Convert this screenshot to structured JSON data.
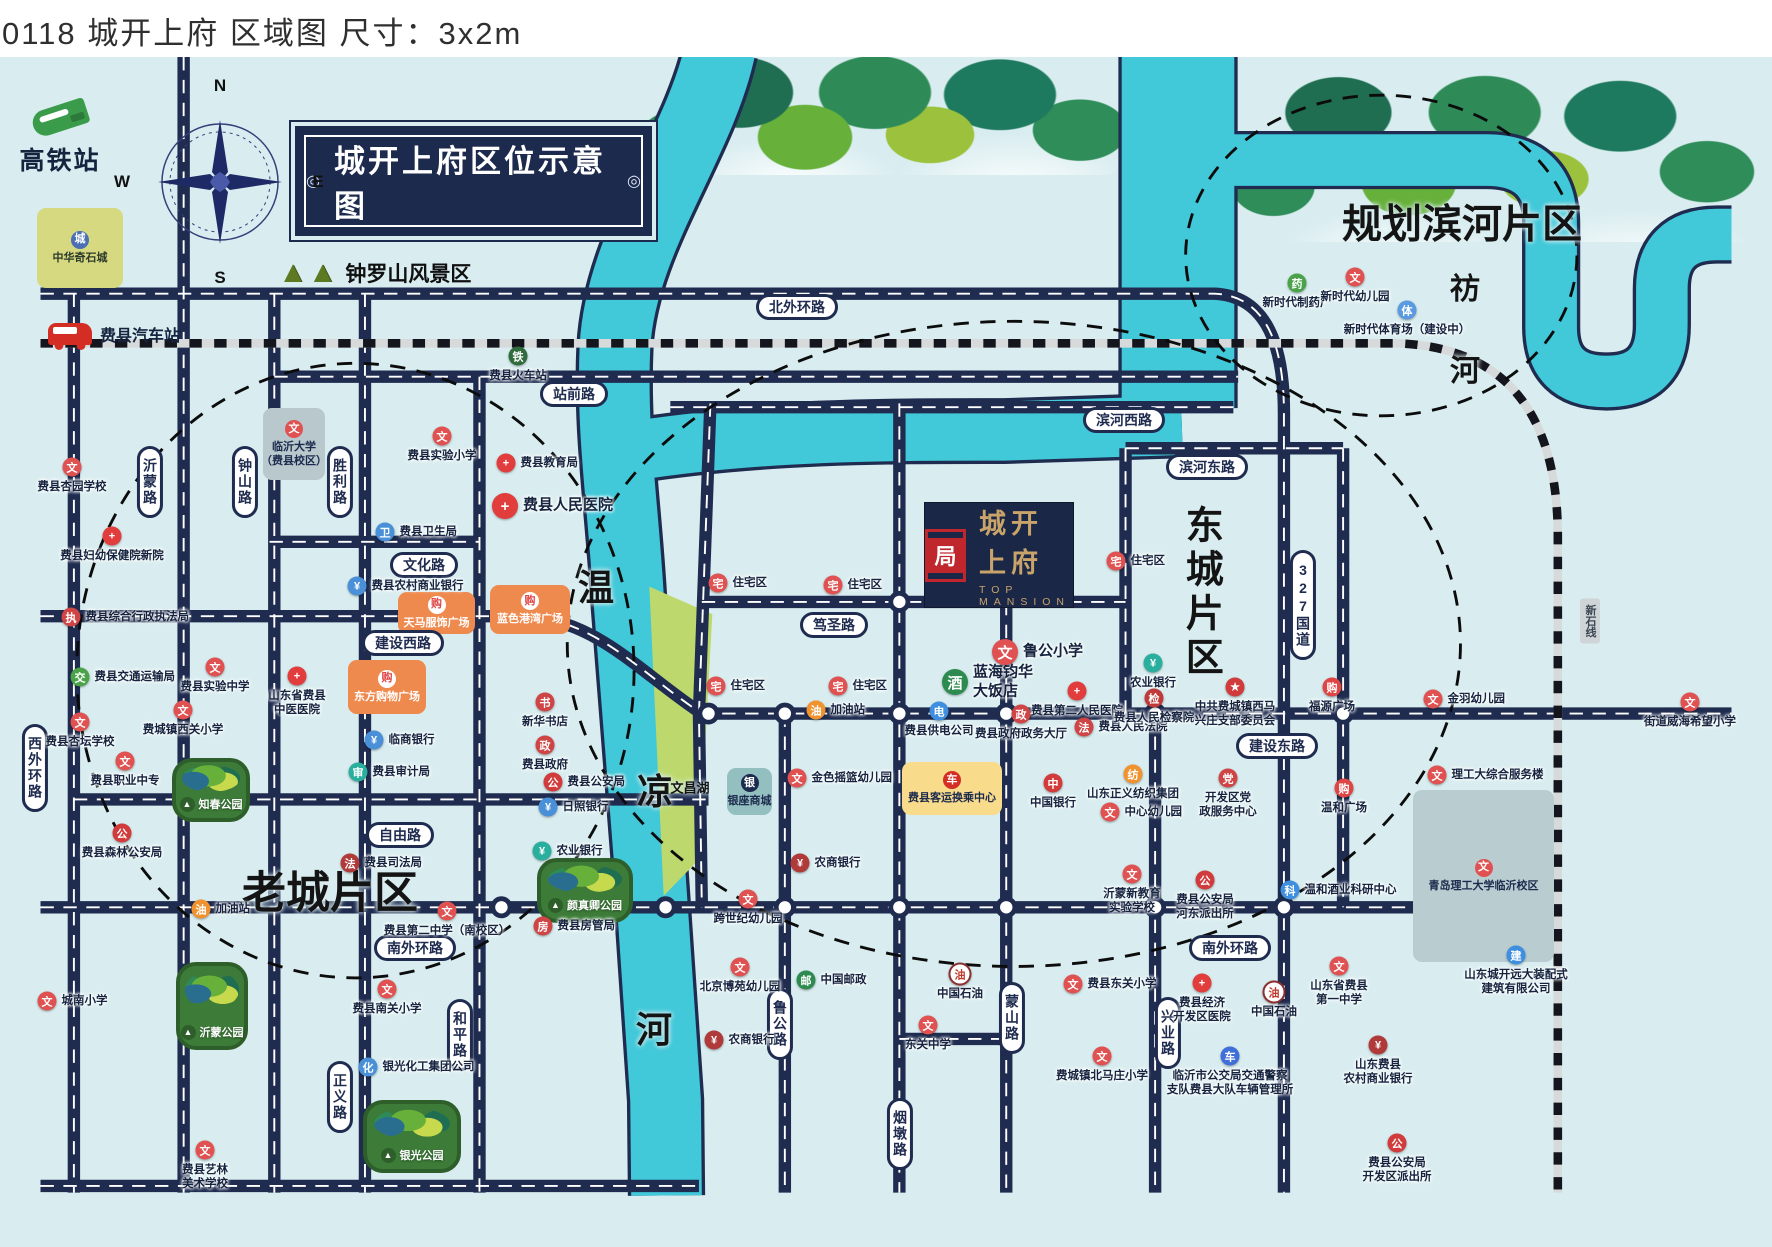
{
  "header": {
    "title": "0118 城开上府 区域图 尺寸：3x2m"
  },
  "banner": {
    "text": "城开上府区位示意图",
    "deco": "◎",
    "x": 295,
    "y": 126,
    "w": 353,
    "h": 106
  },
  "compass": {
    "n": "N",
    "e": "E",
    "s": "S",
    "w": "W",
    "cx": 220,
    "cy": 182,
    "r": 56
  },
  "hsr_station": {
    "label": "高铁站",
    "x": 14,
    "y": 105,
    "w": 92
  },
  "bus_station": {
    "label": "费县汽车站",
    "x": 48,
    "y": 322
  },
  "scenic": {
    "label": "钟罗山风景区",
    "trees": "▲▲",
    "x": 278,
    "y": 258
  },
  "logo": {
    "cn": "城开上府",
    "en": "TOP MANSION",
    "seal": "局",
    "x": 925,
    "y": 503,
    "w": 148,
    "h": 104
  },
  "colors": {
    "bg": "#d9edf0",
    "road": "#1f2c50",
    "river": "#41c8d9",
    "lake": "#bdd96d",
    "rail_base": "#d7dadb",
    "rail_dash": "#15151d",
    "navy": "#1c2a4d",
    "gold": "#c8a36a",
    "seal_red": "#c0272d",
    "orange_box": "#ef8a4e",
    "yellow_box": "#f8dc8c",
    "teal_box": "#93bfc0",
    "gray_box": "#b9cdd1",
    "park_green": "#3c7c38"
  },
  "icon_styles": {
    "school": {
      "bg": "#e05151",
      "g": "文"
    },
    "hospital": {
      "bg": "#e23d3d",
      "g": "+"
    },
    "bankblue": {
      "bg": "#4a90d9",
      "g": "¥"
    },
    "bankred": {
      "bg": "#b03a3a",
      "g": "¥"
    },
    "teal": {
      "bg": "#2aaf9e",
      "g": "¥"
    },
    "govblue": {
      "bg": "#4a90d9",
      "g": "卫"
    },
    "govred": {
      "bg": "#cf4444",
      "g": "政"
    },
    "court": {
      "bg": "#c13a3a",
      "g": "检"
    },
    "pin": {
      "bg": "#d23b3b",
      "g": "公"
    },
    "star": {
      "bg": "#d03b3b",
      "g": "★"
    },
    "green": {
      "bg": "#4aa348",
      "g": "交"
    },
    "gas": {
      "bg": "#f0932f",
      "g": "油"
    },
    "home": {
      "bg": "#e05151",
      "g": "宅"
    },
    "hotel": {
      "bg": "#2e8b4f",
      "g": "酒"
    },
    "power": {
      "bg": "#3f8fe0",
      "g": "电"
    },
    "boc": {
      "bg": "#d23b3b",
      "g": "中"
    },
    "orangeic": {
      "bg": "#f0932f",
      "g": "纺"
    },
    "cart": {
      "bg": "#e04545",
      "g": "购"
    },
    "bluetech": {
      "bg": "#3f8fe0",
      "g": "科"
    },
    "busblue": {
      "bg": "#3f6fd9",
      "g": "车"
    },
    "post": {
      "bg": "#2e8b4f",
      "g": "邮"
    },
    "oil": {
      "bg": "#ffffff",
      "g": "油",
      "fg": "#c0392b",
      "bd": "#8c2f2f"
    },
    "rail": {
      "bg": "#2f6b3c",
      "g": "铁"
    },
    "skater": {
      "bg": "#5a9ae0",
      "g": "体"
    }
  },
  "map": {
    "rivers": [
      {
        "d": "M712,50 C690,150 608,250 602,360 C598,450 610,520 616,620 L638,900 L655,1150 L656,1250",
        "w": 74
      },
      {
        "d": "M620,470 C760,448 900,449 1010,449 L1196,443",
        "w": 62
      },
      {
        "d": "M1192,45 L1192,425",
        "w": 118
      },
      {
        "d": "M1248,165 H1515 Q1583,165 1583,232 V340 Q1583,397 1641,397 Q1699,397 1699,338 V300 Q1699,243 1757,243 L1772,243",
        "w": 54
      }
    ],
    "lake": "638,612 704,641 690,898 653,936",
    "roads": [
      "M0,305 H1230 Q1303,308 1303,430 V1247",
      "M245,392 H1255",
      "M660,424 H1250",
      "M1137,467 H1365",
      "M240,565 H460",
      "M0,643 H500 C580,643 625,700 693,745 H1772",
      "M693,628 H1137",
      "M35,835 H700",
      "M0,948 H1470",
      "M0,1240 H690",
      "M900,1086 H1012",
      "M35,305 V1247",
      "M150,57 V1247",
      "M245,305 V1247",
      "M340,305 V1247",
      "M460,392 V1247",
      "M702,420 L690,745 L693,948",
      "M780,745 V1247",
      "M900,420 V1247",
      "M1012,628 V1247",
      "M1137,467 V745",
      "M1168,745 V1247",
      "M1365,467 V948"
    ],
    "railways": [
      "M0,357 H1420 Q1590,362 1590,560 V1247"
    ],
    "rail_tag": {
      "t": "新石线",
      "x": 1590,
      "y": 621
    },
    "ellipses": [
      {
        "cx": 330,
        "cy": 700,
        "rx": 292,
        "ry": 322
      },
      {
        "cx": 1020,
        "cy": 672,
        "rx": 468,
        "ry": 338
      },
      {
        "cx": 1405,
        "cy": 265,
        "rx": 205,
        "ry": 168
      }
    ],
    "nodes": [
      [
        505,
        643
      ],
      [
        900,
        628
      ],
      [
        700,
        745
      ],
      [
        780,
        745
      ],
      [
        900,
        745
      ],
      [
        1012,
        745
      ],
      [
        1168,
        745
      ],
      [
        1365,
        745
      ],
      [
        483,
        948
      ],
      [
        655,
        948
      ],
      [
        780,
        948
      ],
      [
        900,
        948
      ],
      [
        1012,
        948
      ],
      [
        1168,
        948
      ],
      [
        1303,
        948
      ],
      [
        1468,
        948
      ]
    ],
    "pills": [
      {
        "t": "北外环路",
        "x": 797,
        "y": 307
      },
      {
        "t": "站前路",
        "x": 574,
        "y": 394
      },
      {
        "t": "滨河西路",
        "x": 1124,
        "y": 420
      },
      {
        "t": "滨河东路",
        "x": 1207,
        "y": 467
      },
      {
        "t": "文化路",
        "x": 424,
        "y": 565
      },
      {
        "t": "建设西路",
        "x": 403,
        "y": 643
      },
      {
        "t": "笃圣路",
        "x": 834,
        "y": 625
      },
      {
        "t": "建设东路",
        "x": 1277,
        "y": 746
      },
      {
        "t": "自由路",
        "x": 400,
        "y": 835
      },
      {
        "t": "南外环路",
        "x": 415,
        "y": 948
      },
      {
        "t": "南外环路",
        "x": 1230,
        "y": 948
      },
      {
        "t": "沂蒙路",
        "x": 150,
        "y": 482,
        "v": 1
      },
      {
        "t": "钟山路",
        "x": 245,
        "y": 482,
        "v": 1
      },
      {
        "t": "胜利路",
        "x": 340,
        "y": 482,
        "v": 1
      },
      {
        "t": "西外环路",
        "x": 35,
        "y": 768,
        "v": 1
      },
      {
        "t": "和平路",
        "x": 460,
        "y": 1035,
        "v": 1
      },
      {
        "t": "正义路",
        "x": 340,
        "y": 1097,
        "v": 1
      },
      {
        "t": "鲁公路",
        "x": 780,
        "y": 1024,
        "v": 1
      },
      {
        "t": "烟墩路",
        "x": 900,
        "y": 1134,
        "v": 1
      },
      {
        "t": "蒙山路",
        "x": 1012,
        "y": 1018,
        "v": 1
      },
      {
        "t": "兴业路",
        "x": 1168,
        "y": 1033,
        "v": 1
      },
      {
        "t": "327国道",
        "x": 1303,
        "y": 605,
        "v": 1
      }
    ],
    "region_labels": [
      {
        "t": "规划滨河片区",
        "x": 1462,
        "y": 225,
        "s": 40
      },
      {
        "t": "老城片区",
        "x": 330,
        "y": 893,
        "s": 44
      },
      {
        "t": "东城片区",
        "x": 1200,
        "y": 593,
        "s": 38,
        "v": 1
      },
      {
        "t": "温",
        "x": 596,
        "y": 588,
        "s": 36,
        "serif": 1
      },
      {
        "t": "凉",
        "x": 655,
        "y": 792,
        "s": 36,
        "serif": 1
      },
      {
        "t": "河",
        "x": 654,
        "y": 1030,
        "s": 36,
        "serif": 1
      },
      {
        "t": "祊",
        "x": 1465,
        "y": 290,
        "s": 30,
        "serif": 1
      },
      {
        "t": "河",
        "x": 1465,
        "y": 372,
        "s": 30,
        "serif": 1
      },
      {
        "t": "文昌湖",
        "x": 690,
        "y": 789,
        "s": 13
      }
    ],
    "pois": [
      {
        "t": "费县火车站",
        "x": 518,
        "y": 356,
        "c": "rail",
        "lp": "below"
      },
      {
        "t": "费县杏园学校",
        "x": 72,
        "y": 467,
        "c": "school",
        "lp": "below"
      },
      {
        "t": "费县实验小学",
        "x": 442,
        "y": 436,
        "c": "school",
        "lp": "below"
      },
      {
        "t": "费县教育局",
        "x": 506,
        "y": 463,
        "c": "hospital",
        "lp": "right"
      },
      {
        "t": "费县人民医院",
        "x": 505,
        "y": 506,
        "c": "hospital",
        "lp": "right",
        "big": 1
      },
      {
        "t": "费县妇幼保健院新院",
        "x": 112,
        "y": 536,
        "c": "hospital",
        "lp": "below"
      },
      {
        "t": "费县卫生局",
        "x": 385,
        "y": 532,
        "c": "govblue",
        "lp": "right"
      },
      {
        "t": "费县农村商业银行",
        "x": 357,
        "y": 586,
        "c": "bankblue",
        "lp": "right"
      },
      {
        "t": "费县综合行政执法局",
        "x": 71,
        "y": 617,
        "c": "govred",
        "lp": "right",
        "g": "执"
      },
      {
        "t": "费县交通运输局",
        "x": 80,
        "y": 677,
        "c": "green",
        "lp": "right"
      },
      {
        "t": "费县实验中学",
        "x": 215,
        "y": 667,
        "c": "school",
        "lp": "below"
      },
      {
        "t": "山东省费县\n中医医院",
        "x": 297,
        "y": 676,
        "c": "hospital",
        "lp": "below"
      },
      {
        "t": "费城镇西关小学",
        "x": 183,
        "y": 710,
        "c": "school",
        "lp": "below"
      },
      {
        "t": "费县杏坛学校",
        "x": 80,
        "y": 722,
        "c": "school",
        "lp": "below"
      },
      {
        "t": "费县职业中专",
        "x": 125,
        "y": 761,
        "c": "school",
        "lp": "below"
      },
      {
        "t": "临商银行",
        "x": 374,
        "y": 740,
        "c": "bankblue",
        "lp": "right"
      },
      {
        "t": "费县审计局",
        "x": 358,
        "y": 772,
        "c": "teal",
        "lp": "right",
        "g": "审"
      },
      {
        "t": "新华书店",
        "x": 545,
        "y": 702,
        "c": "govred",
        "lp": "below",
        "g": "书"
      },
      {
        "t": "费县政府",
        "x": 545,
        "y": 745,
        "c": "govred",
        "lp": "below"
      },
      {
        "t": "费县公安局",
        "x": 553,
        "y": 782,
        "c": "pin",
        "lp": "right"
      },
      {
        "t": "日照银行",
        "x": 548,
        "y": 807,
        "c": "bankblue",
        "lp": "right"
      },
      {
        "t": "费县森林公安局",
        "x": 122,
        "y": 833,
        "c": "pin",
        "lp": "below"
      },
      {
        "t": "加油站",
        "x": 201,
        "y": 909,
        "c": "gas",
        "lp": "right"
      },
      {
        "t": "费县司法局",
        "x": 350,
        "y": 863,
        "c": "bankred",
        "lp": "right",
        "g": "法"
      },
      {
        "t": "农业银行",
        "x": 542,
        "y": 851,
        "c": "teal",
        "lp": "right"
      },
      {
        "t": "费县房管局",
        "x": 543,
        "y": 926,
        "c": "govred",
        "lp": "right",
        "g": "房"
      },
      {
        "t": "费县第二中学（南校区）",
        "x": 447,
        "y": 911,
        "c": "school",
        "lp": "below"
      },
      {
        "t": "城南小学",
        "x": 47,
        "y": 1001,
        "c": "school",
        "lp": "right"
      },
      {
        "t": "费县南关小学",
        "x": 387,
        "y": 989,
        "c": "school",
        "lp": "below"
      },
      {
        "t": "银光化工集团公司",
        "x": 368,
        "y": 1067,
        "c": "bankblue",
        "lp": "right",
        "g": "化"
      },
      {
        "t": "费县艺林\n美术学校",
        "x": 205,
        "y": 1150,
        "c": "school",
        "lp": "below"
      },
      {
        "t": "加油站",
        "x": 816,
        "y": 710,
        "c": "gas",
        "lp": "right"
      },
      {
        "t": "住宅区",
        "x": 718,
        "y": 583,
        "c": "home",
        "lp": "right"
      },
      {
        "t": "住宅区",
        "x": 833,
        "y": 585,
        "c": "home",
        "lp": "right"
      },
      {
        "t": "住宅区",
        "x": 716,
        "y": 686,
        "c": "home",
        "lp": "right"
      },
      {
        "t": "住宅区",
        "x": 838,
        "y": 686,
        "c": "home",
        "lp": "right"
      },
      {
        "t": "住宅区",
        "x": 1116,
        "y": 561,
        "c": "home",
        "lp": "right"
      },
      {
        "t": "鲁公小学",
        "x": 1005,
        "y": 652,
        "c": "school",
        "lp": "right",
        "big": 1
      },
      {
        "t": "蓝海钧华\n大饭店",
        "x": 955,
        "y": 682,
        "c": "hotel",
        "lp": "right",
        "big": 1
      },
      {
        "t": "费县供电公司",
        "x": 939,
        "y": 711,
        "c": "power",
        "lp": "below"
      },
      {
        "t": "费县政府政务大厅",
        "x": 1021,
        "y": 714,
        "c": "govred",
        "lp": "below"
      },
      {
        "t": "费县第二人民医院",
        "x": 1077,
        "y": 691,
        "c": "hospital",
        "lp": "below"
      },
      {
        "t": "费县人民法院",
        "x": 1084,
        "y": 727,
        "c": "govred",
        "lp": "right",
        "g": "法"
      },
      {
        "t": "费县人民检察院",
        "x": 1154,
        "y": 698,
        "c": "court",
        "lp": "below"
      },
      {
        "t": "农业银行",
        "x": 1153,
        "y": 663,
        "c": "teal",
        "lp": "below"
      },
      {
        "t": "金色摇篮幼儿园",
        "x": 797,
        "y": 778,
        "c": "school",
        "lp": "right"
      },
      {
        "t": "中国银行",
        "x": 1053,
        "y": 783,
        "c": "boc",
        "lp": "below"
      },
      {
        "t": "山东正义纺织集团",
        "x": 1133,
        "y": 774,
        "c": "orangeic",
        "lp": "below"
      },
      {
        "t": "中心幼儿园",
        "x": 1110,
        "y": 812,
        "c": "school",
        "lp": "right"
      },
      {
        "t": "沂蒙新教育\n实验学校",
        "x": 1132,
        "y": 874,
        "c": "school",
        "lp": "below"
      },
      {
        "t": "开发区党\n政服务中心",
        "x": 1228,
        "y": 778,
        "c": "govred",
        "lp": "below",
        "g": "党"
      },
      {
        "t": "费县公安局\n河东派出所",
        "x": 1205,
        "y": 880,
        "c": "pin",
        "lp": "below"
      },
      {
        "t": "温和广场",
        "x": 1344,
        "y": 788,
        "c": "cart",
        "lp": "below"
      },
      {
        "t": "温和酒业科研中心",
        "x": 1290,
        "y": 890,
        "c": "bluetech",
        "lp": "right"
      },
      {
        "t": "中共费城镇西马\n兴庄支部委员会",
        "x": 1235,
        "y": 687,
        "c": "star",
        "lp": "below"
      },
      {
        "t": "福源广场",
        "x": 1332,
        "y": 687,
        "c": "cart",
        "lp": "below"
      },
      {
        "t": "金羽幼儿园",
        "x": 1433,
        "y": 699,
        "c": "school",
        "lp": "right"
      },
      {
        "t": "街道威海希望小学",
        "x": 1690,
        "y": 702,
        "c": "school",
        "lp": "below"
      },
      {
        "t": "理工大综合服务楼",
        "x": 1437,
        "y": 775,
        "c": "school",
        "lp": "right"
      },
      {
        "t": "农商银行",
        "x": 800,
        "y": 863,
        "c": "bankred",
        "lp": "right"
      },
      {
        "t": "跨世纪幼儿园",
        "x": 748,
        "y": 899,
        "c": "school",
        "lp": "below"
      },
      {
        "t": "北京博苑幼儿园",
        "x": 740,
        "y": 967,
        "c": "school",
        "lp": "below"
      },
      {
        "t": "中国邮政",
        "x": 806,
        "y": 980,
        "c": "post",
        "lp": "right"
      },
      {
        "t": "农商银行",
        "x": 714,
        "y": 1040,
        "c": "bankred",
        "lp": "right"
      },
      {
        "t": "东关中学",
        "x": 928,
        "y": 1025,
        "c": "school",
        "lp": "below"
      },
      {
        "t": "中国石油",
        "x": 960,
        "y": 974,
        "c": "oil",
        "lp": "below"
      },
      {
        "t": "费县东关小学",
        "x": 1073,
        "y": 984,
        "c": "school",
        "lp": "right"
      },
      {
        "t": "费城镇北马庄小学",
        "x": 1102,
        "y": 1056,
        "c": "school",
        "lp": "below"
      },
      {
        "t": "费县经济\n开发区医院",
        "x": 1202,
        "y": 983,
        "c": "hospital",
        "lp": "below"
      },
      {
        "t": "临沂市公交局交通警察\n支队费县大队车辆管理所",
        "x": 1230,
        "y": 1056,
        "c": "busblue",
        "lp": "below"
      },
      {
        "t": "中国石油",
        "x": 1274,
        "y": 992,
        "c": "oil",
        "lp": "below"
      },
      {
        "t": "山东省费县\n第一中学",
        "x": 1339,
        "y": 966,
        "c": "school",
        "lp": "below"
      },
      {
        "t": "山东城开远大装配式\n建筑有限公司",
        "x": 1516,
        "y": 955,
        "c": "bluetech",
        "lp": "below",
        "g": "建"
      },
      {
        "t": "山东费县\n农村商业银行",
        "x": 1378,
        "y": 1045,
        "c": "bankred",
        "lp": "below"
      },
      {
        "t": "费县公安局\n开发区派出所",
        "x": 1397,
        "y": 1143,
        "c": "pin",
        "lp": "below"
      },
      {
        "t": "新时代制药厂",
        "x": 1297,
        "y": 283,
        "c": "green",
        "lp": "below",
        "g": "药"
      },
      {
        "t": "新时代幼儿园",
        "x": 1355,
        "y": 277,
        "c": "school",
        "lp": "below"
      },
      {
        "t": "新时代体育场（建设中）",
        "x": 1407,
        "y": 310,
        "c": "skater",
        "lp": "below"
      }
    ],
    "boxes": [
      {
        "t": "中华奇石城",
        "x": 37,
        "y": 208,
        "w": 86,
        "h": 80,
        "bg": "#d6d97f",
        "tc": "#2c3a2a",
        "ic": "#4a6fb5",
        "g": "城"
      },
      {
        "t": "临沂大学\n（费县校区）",
        "x": 263,
        "y": 408,
        "w": 62,
        "h": 72,
        "bg": "#b8c8cc",
        "tc": "#1c2a4d",
        "ic": "#e05151",
        "g": "文"
      },
      {
        "t": "天马服饰广场",
        "x": 398,
        "y": 592,
        "w": 77,
        "h": 42,
        "bg": "#ef8a4e",
        "tc": "#ffffff",
        "ic": "#ffffff",
        "g": "购",
        "igc": "#e04545"
      },
      {
        "t": "蓝色港湾广场",
        "x": 490,
        "y": 585,
        "w": 80,
        "h": 49,
        "bg": "#ef8a4e",
        "tc": "#ffffff",
        "ic": "#ffffff",
        "g": "购",
        "igc": "#e04545"
      },
      {
        "t": "东方购物广场",
        "x": 348,
        "y": 660,
        "w": 78,
        "h": 54,
        "bg": "#ef8a4e",
        "tc": "#ffffff",
        "ic": "#ffffff",
        "g": "购",
        "igc": "#e04545"
      },
      {
        "t": "费县客运换乘中心",
        "x": 902,
        "y": 762,
        "w": 100,
        "h": 53,
        "bg": "#f8dc8c",
        "tc": "#1c2a4d",
        "ic": "#d42d23",
        "g": "车"
      },
      {
        "t": "银座商城",
        "x": 727,
        "y": 768,
        "w": 45,
        "h": 47,
        "bg": "#93bfc0",
        "tc": "#1c2a4d",
        "ic": "#1c2a4d",
        "g": "银"
      },
      {
        "t": "青岛理工大学临沂校区",
        "x": 1413,
        "y": 790,
        "w": 141,
        "h": 172,
        "bg": "#b9cdd1",
        "tc": "#1c2a4d",
        "ic": "#e05151",
        "g": "文"
      }
    ],
    "parks": [
      {
        "t": "知春公园",
        "x": 172,
        "y": 758,
        "w": 70,
        "h": 56
      },
      {
        "t": "沂蒙公园",
        "x": 176,
        "y": 962,
        "w": 64,
        "h": 80
      },
      {
        "t": "颜真卿公园",
        "x": 537,
        "y": 858,
        "w": 88,
        "h": 57
      },
      {
        "t": "银光公园",
        "x": 363,
        "y": 1100,
        "w": 90,
        "h": 65
      }
    ],
    "forests": [
      {
        "x": 640,
        "y": 57,
        "w": 500,
        "h": 118
      },
      {
        "x": 1230,
        "y": 57,
        "w": 542,
        "h": 185
      }
    ]
  }
}
